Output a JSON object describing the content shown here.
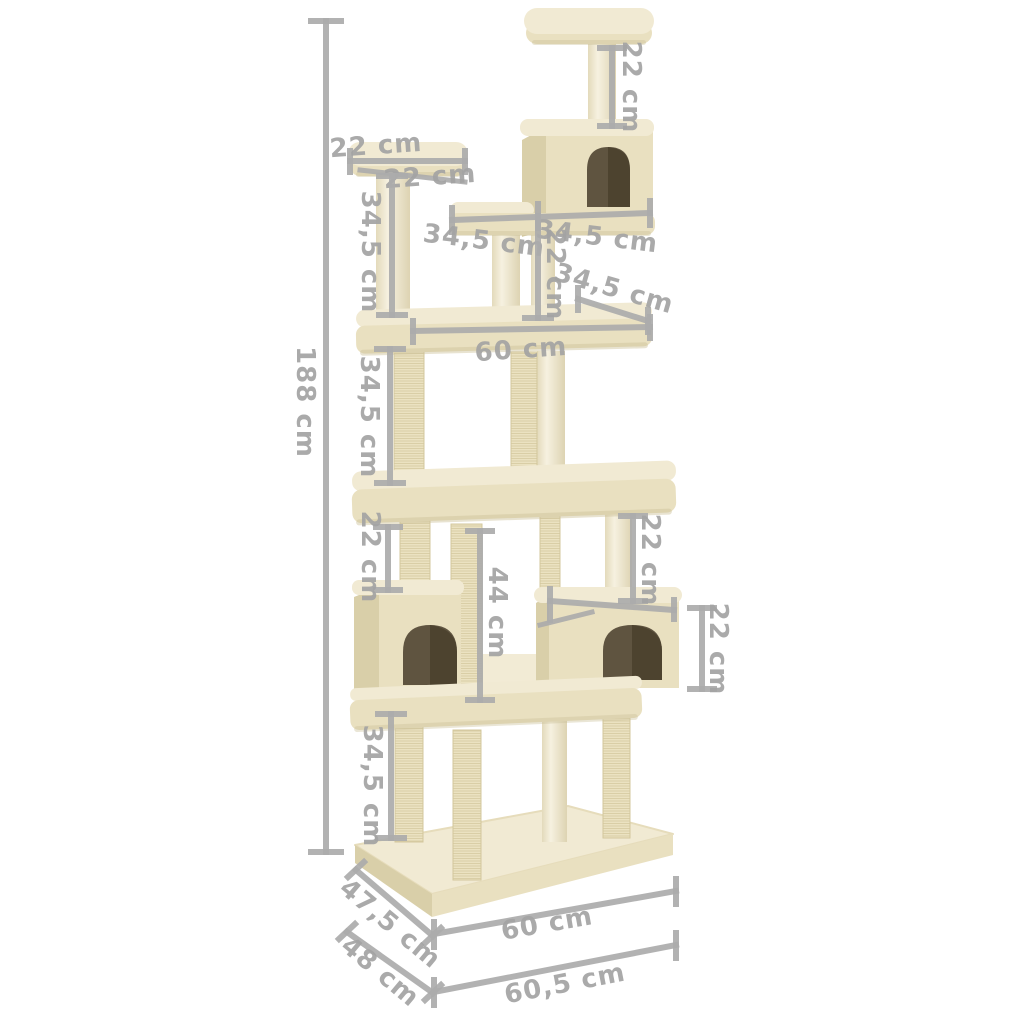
{
  "diagram": {
    "type": "product-dimension-diagram",
    "subject": "cat tree with scratching posts, perches and condos",
    "unit": "cm"
  },
  "colors": {
    "background": "#ffffff",
    "plush_top": "#f1ead3",
    "plush_mid": "#e9e0c0",
    "plush_side": "#d9cfa9",
    "plush_deep": "#cbc098",
    "post": "#f2edda",
    "post_edge": "#e0d7b8",
    "sisal": "#eae1bf",
    "sisal_line": "#d7cca2",
    "door": "#5f5440",
    "door_deep": "#473d29",
    "dim_line": "#ababab",
    "dim_text": "#a3a3a3"
  },
  "dimensions": {
    "overall_height": "188 cm",
    "top_post_height": "22 cm",
    "top_perch_width": "22 cm",
    "top_perch_depth": "22 cm",
    "upper_left_post_height": "34,5 cm",
    "upper_platform_left_span": "34,5 cm",
    "upper_platform_right_span": "34,5 cm",
    "middle_post_height": "22 cm",
    "middle_platform_depth": "34,5 cm",
    "middle_platform_width": "60 cm",
    "lower_post_height": "34,5 cm",
    "left_condo_post_height": "22 cm",
    "right_condo_post_height": "22 cm",
    "center_post_height": "44 cm",
    "right_condo_height": "22 cm",
    "base_post_height": "34,5 cm",
    "base_depth_upper": "47,5 cm",
    "base_depth_lower": "48 cm",
    "base_width_upper": "60 cm",
    "base_width_lower": "60,5 cm"
  }
}
